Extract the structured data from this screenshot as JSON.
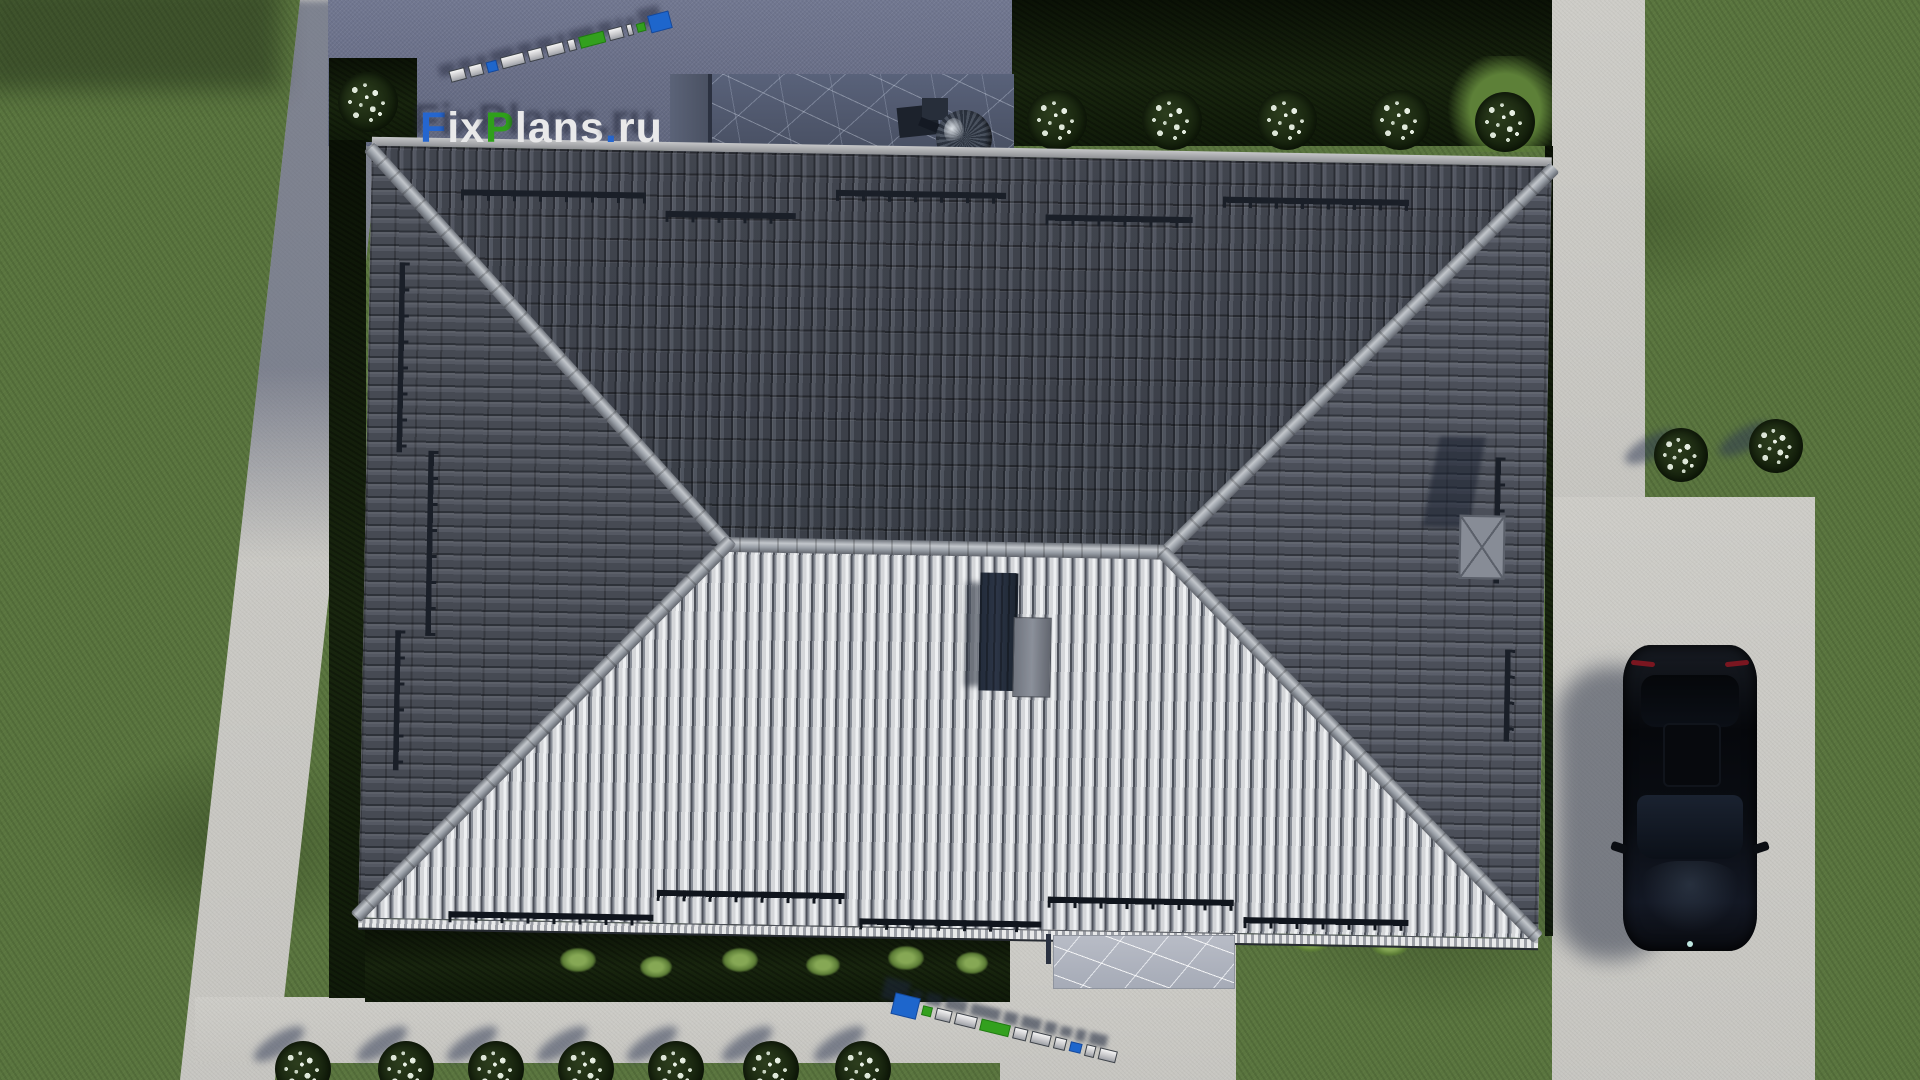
{
  "scene": {
    "description": "Aerial top-down 3D render of a single-family house hip roof with yard, concrete paths, driveway and parked black car",
    "objects": {
      "building": "hip roof with dark north slope, bright south slope, two side slopes",
      "roof_equipment": "satellite dish, center chimney, roof hatch with cross cap, snow guard rails",
      "vehicle": "black car parked on driveway, nose facing down",
      "vegetation": "lawn, dark hedges, white flowering shrubs, small green tufts",
      "hardscape": "left garden path, bottom path, right walkway and driveway, two stone patios"
    }
  },
  "watermark": {
    "full": "FixPlans.ru",
    "f": "F",
    "ix": "ix",
    "p": "P",
    "lans": "lans",
    "dot": ".",
    "ru": "ru",
    "brand_blue": "#1e66cc",
    "brand_green": "#33a01e",
    "text_white": "#e9e9ea"
  },
  "palette": {
    "grass": "#5a753f",
    "grass_dark": "#46602f",
    "concrete": "#d1d0cb",
    "shadow_paving": "#7b819b",
    "roof_dark_slope": "#4a4e57",
    "roof_light_slope": "#c9cbd0",
    "roof_side_slope": "#52565f",
    "ridge_cap": "#a7adb4",
    "hedge": "#14200c",
    "stone_dark": "#4e5669",
    "stone_light": "#b2b6c0",
    "car_black": "#0a0d12"
  }
}
